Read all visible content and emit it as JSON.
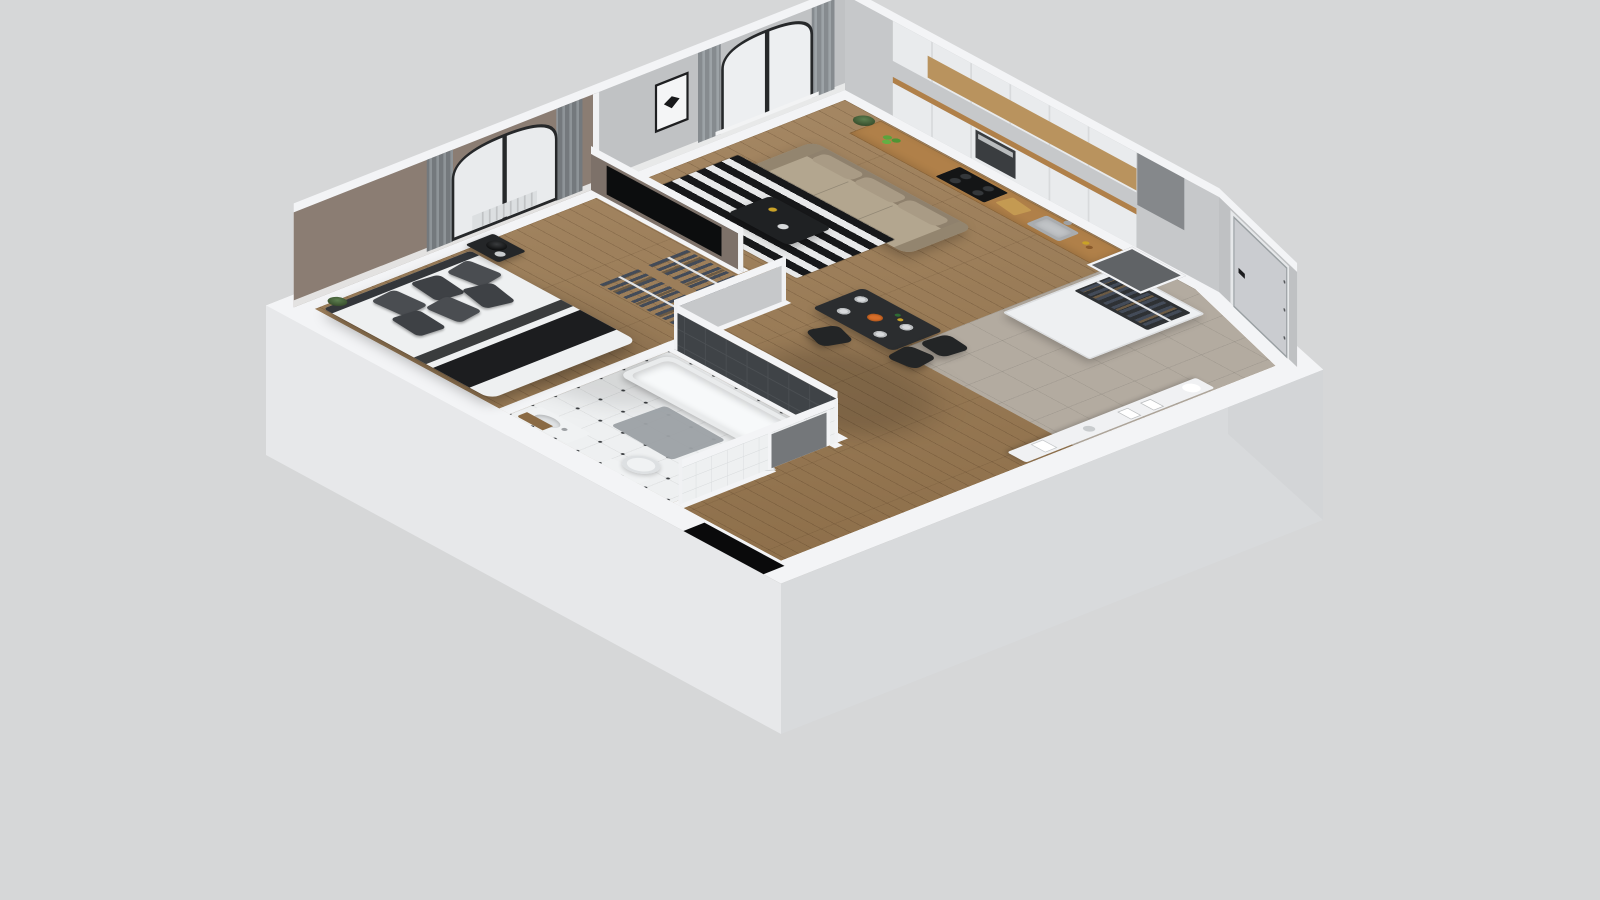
{
  "meta": {
    "title": "3D apartment floor plan render",
    "view": "dollhouse cutaway, birds-eye isometric",
    "visible_text": "none"
  },
  "palette": {
    "background": "#d6d7d8",
    "slab_top": "#f3f4f6",
    "slab_side_left": "#e7e8ea",
    "slab_side_right": "#d8dadc",
    "slab_side_chamfer": "#d3d5d7",
    "wall_living_gray": "#c0c2c4",
    "wall_kitchen_gray": "#c6c8ca",
    "wall_taupe": "#8b7d73",
    "wall_partition_taupe": "#7d7169",
    "wall_hall_gray": "#c6c8ca",
    "wall_entry_gray": "#bfc1c3",
    "wall_bath_dark": "#3f4347",
    "wall_bath_white_tile": "#eef0f1",
    "wall_top_white": "#f3f4f6",
    "floor_wood": "#9a7951",
    "floor_entry_tile": "#b3aba0",
    "floor_bathroom": "#eef0f1",
    "cabinet_white": "#e9ebed",
    "wood_shelf": "#b9935e",
    "counter_wood": "#b08049",
    "oven_steel": "#3a3d40",
    "cooktop_black": "#141516",
    "sofa_body": "#b3a68f",
    "sofa_back": "#8f816d",
    "rug_dark": "#17181a",
    "rug_light": "#e8e9ea",
    "coffee_table": "#1f2123",
    "tv_black": "#0c0d0e",
    "dining_table": "#2b2d2f",
    "chair_black": "#232526",
    "bed_linen": "#eef0f1",
    "pillow_gray": "#4a4d51",
    "throw_black": "#1c1d1f",
    "nightstand_black": "#242628",
    "tub_white": "#e9ebec",
    "door_gray": "#caccd0",
    "door_handle": "#1b1c1e",
    "curtain_gray": "#83888c",
    "sheer_white": "#edeff1",
    "window_frame": "#26282a",
    "plant_green": "#4f6b45",
    "console_white": "#f0f1f3",
    "black_mat": "#0a0a0b"
  },
  "scene": {
    "rooms": [
      {
        "id": "living-room",
        "floor": "wood planks",
        "furniture": [
          "beige 3-seat sofa",
          "black-white striped rug",
          "black coffee table",
          "wall TV on taupe partition",
          "framed butterfly art",
          "arched window with gray curtains",
          "corner plants"
        ]
      },
      {
        "id": "kitchen",
        "floor": "light tile / wood",
        "furniture": [
          "white upper cabinets",
          "oak open shelf",
          "wood countertop",
          "black cooktop",
          "stainless oven",
          "steel sink",
          "green apples",
          "bottles"
        ]
      },
      {
        "id": "dining-area",
        "floor": "wood planks",
        "furniture": [
          "black dining table with plates and fruit bowl",
          "three black chairs"
        ]
      },
      {
        "id": "bedroom",
        "floor": "wood planks",
        "furniture": [
          "double bed with white linen",
          "dark gray pillows",
          "black throw blanket",
          "black nightstand with lamp",
          "arched window with curtains",
          "radiator",
          "open clothes racks"
        ]
      },
      {
        "id": "bathroom",
        "floor": "white octagon tile with black dots",
        "furniture": [
          "white bathtub",
          "dark tiled wall",
          "gray bath mat",
          "vanity with sink",
          "toilet",
          "inward-opening white door"
        ]
      },
      {
        "id": "entry-hall",
        "floor": "gray tile",
        "furniture": [
          "front door on angled wall",
          "open wardrobe with hanging clothes",
          "white console with decor",
          "ventilation shaft"
        ]
      }
    ]
  }
}
